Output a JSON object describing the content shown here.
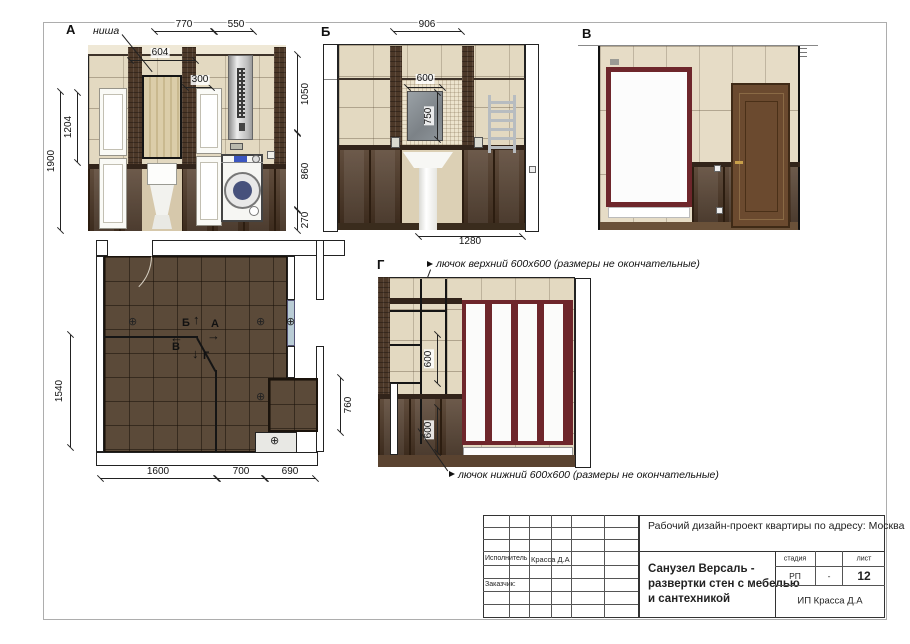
{
  "views": {
    "a": {
      "label": "А",
      "niche": "ниша",
      "dim_770": "770",
      "dim_550": "550",
      "dim_604": "604",
      "dim_300": "300",
      "dim_1900": "1900",
      "dim_1204": "1204",
      "dim_1050": "1050",
      "dim_860": "860",
      "dim_270": "270"
    },
    "b": {
      "label": "Б",
      "dim_906": "906",
      "dim_600": "600",
      "dim_750": "750",
      "dim_1280": "1280"
    },
    "v": {
      "label": "В"
    },
    "g": {
      "label": "Г",
      "hatch_top": "лючок верхний 600х600 (размеры не окончательные)",
      "hatch_bottom": "лючок нижний 600х600 (размеры не окончательные)",
      "dim_600_upper": "600",
      "dim_600_lower": "600"
    }
  },
  "plan": {
    "dim_1540": "1540",
    "dim_1600": "1600",
    "dim_700": "700",
    "dim_690": "690",
    "dim_760": "760",
    "marker_up": "Б",
    "marker_right": "А",
    "marker_left": "В",
    "marker_down": "Г",
    "arrow_up": "↑",
    "arrow_right": "→",
    "arrow_left": "←",
    "arrow_down": "↓",
    "light_icon": "⊕"
  },
  "titleblock": {
    "project": "Рабочий дизайн-проект квартиры по адресу: Москва",
    "executor_label": "Исполнитель",
    "executor_value": "Красса Д.А",
    "client_label": "Заказчик:",
    "sheet_title": "Санузел Версаль -\nразвертки стен с мебелью\nи сантехникой",
    "stage_label": "стадия",
    "stage_value": "РП",
    "stage_dash": "-",
    "sheet_label": "лист",
    "sheet_number": "12",
    "company": "ИП Красса Д.А"
  },
  "colors": {
    "tile": "#e3d9c1",
    "mosaic": "#4c3828",
    "wainscot": "#4e3826",
    "maroon": "#6e262b",
    "floor": "#5b4a39",
    "glass": "#b9ccd5"
  }
}
